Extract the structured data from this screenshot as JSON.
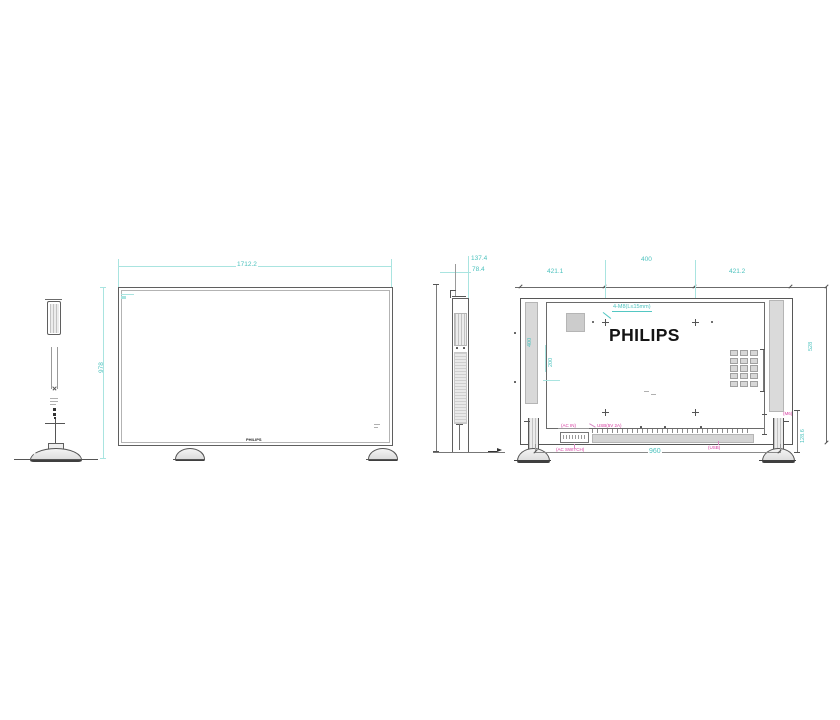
{
  "views": {
    "front": {
      "width_dim": "1712.2",
      "height_dim": "978",
      "bottom_logo": "PHILIPS"
    },
    "side": {
      "depth_total_dim": "137.4",
      "depth_body_dim": "78.4"
    },
    "rear": {
      "logo": "PHILIPS",
      "dim_top_left": "421.1",
      "dim_top_center": "400",
      "dim_top_right": "421.2",
      "vesa_note": "4-M8(L≤15mm)",
      "dim_vesa_vertical": "400",
      "dim_vesa_half": "200",
      "dim_bottom_width": "960",
      "dim_right_height": "528",
      "dim_foot_height": "128.6",
      "port_labels": {
        "ac_in": "(AC IN)",
        "usb": "USB(5V 2A)",
        "ac_switch": "(AC SWITCH)",
        "usb2": "(USB)",
        "screw": "(M6)"
      }
    }
  },
  "colors": {
    "dimension_text": "#4cc2be",
    "dimension_line": "#a9e4e0",
    "outline": "#5f5f5f",
    "annotation_magenta": "#d6399f",
    "fill_gray": "#d9d9d9",
    "logo_black": "#141414"
  }
}
